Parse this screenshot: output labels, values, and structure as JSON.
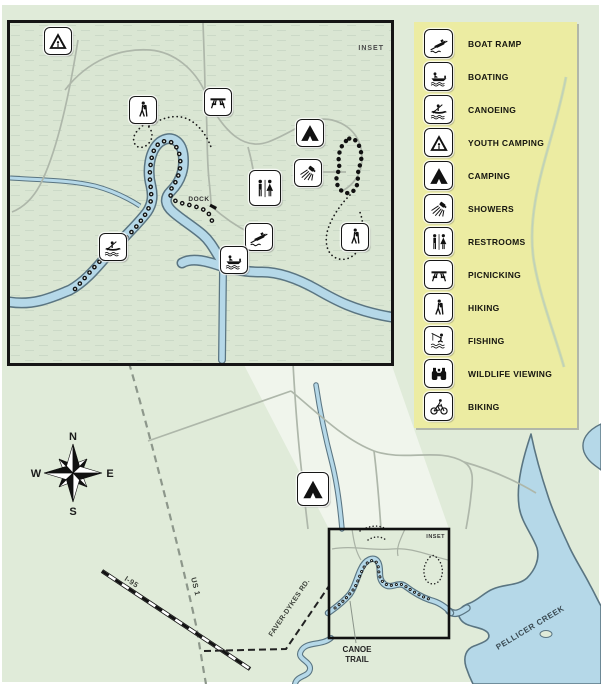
{
  "legend": {
    "items": [
      {
        "label": "BOAT RAMP",
        "icon": "boat-ramp-icon"
      },
      {
        "label": "BOATING",
        "icon": "boating-icon"
      },
      {
        "label": "CANOEING",
        "icon": "canoeing-icon"
      },
      {
        "label": "YOUTH CAMPING",
        "icon": "youth-camping-icon"
      },
      {
        "label": "CAMPING",
        "icon": "camping-icon"
      },
      {
        "label": "SHOWERS",
        "icon": "showers-icon"
      },
      {
        "label": "RESTROOMS",
        "icon": "restrooms-icon"
      },
      {
        "label": "PICNICKING",
        "icon": "picnicking-icon"
      },
      {
        "label": "HIKING",
        "icon": "hiking-icon"
      },
      {
        "label": "FISHING",
        "icon": "fishing-icon"
      },
      {
        "label": "WILDLIFE VIEWING",
        "icon": "wildlife-viewing-icon"
      },
      {
        "label": "BIKING",
        "icon": "biking-icon"
      }
    ]
  },
  "compass": {
    "north": "N",
    "east": "E",
    "south": "S",
    "west": "W"
  },
  "inset_map": {
    "title": "INSET",
    "dock_label": "DOCK"
  },
  "main_map": {
    "inset_box_label": "INSET",
    "labels": {
      "us_1": "US 1",
      "i_95": "I-95",
      "faver_dykes_rd": "FAVER-DYKES RD.",
      "canoe_trail_line1": "CANOE",
      "canoe_trail_line2": "TRAIL",
      "pellicer_creek": "PELLICER CREEK"
    },
    "map_icons": [
      "camping"
    ]
  },
  "inset_icons": [
    "youth-camping",
    "hiking",
    "picnicking",
    "camping",
    "showers",
    "restrooms",
    "canoeing",
    "boat-ramp",
    "boating",
    "hiking"
  ],
  "colors": {
    "land": "#e0ebd9",
    "inset_land": "#dae6d3",
    "water": "#b5d8e8",
    "water_outline": "#5a7582",
    "road": "#aeb7aa",
    "legend_bg": "#ececa2",
    "trail": "#161616"
  }
}
